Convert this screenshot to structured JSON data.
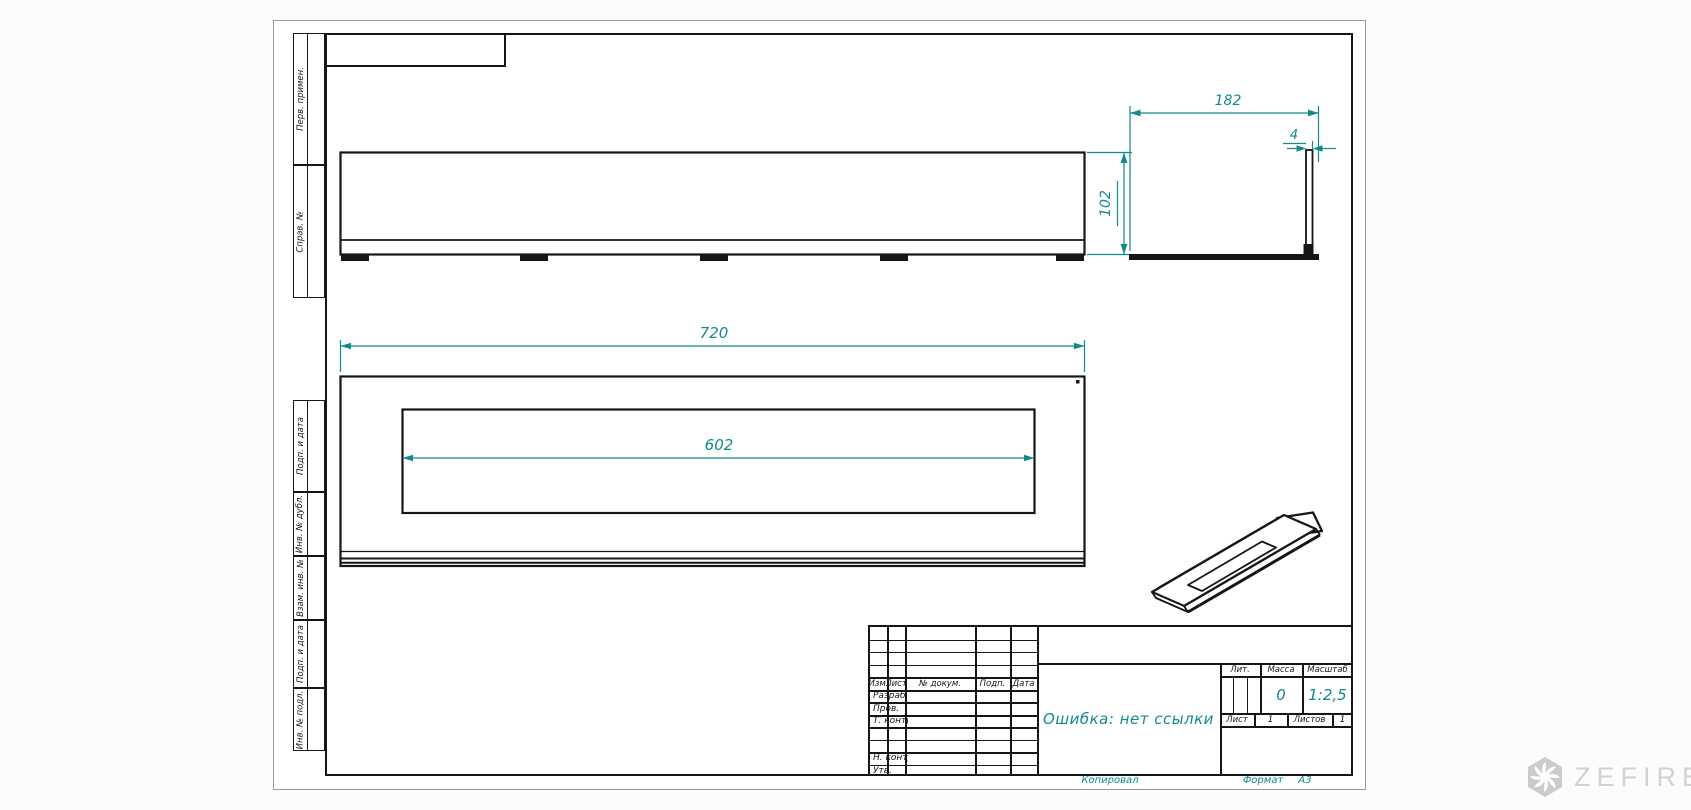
{
  "colors": {
    "accent": "#12898b",
    "line": "#161616",
    "watermark_gray": "#cbcbcb"
  },
  "frame": {
    "strips_top": [
      {
        "label": "Перв. примен."
      },
      {
        "label": "Справ. №"
      }
    ],
    "strips_bottom": [
      {
        "label": "Подп. и дата"
      },
      {
        "label": "Инв. № дубл."
      },
      {
        "label": "Взам. инв. №"
      },
      {
        "label": "Подп. и дата"
      },
      {
        "label": "Инв. № подл."
      }
    ]
  },
  "views": {
    "dims": {
      "overall_width": "720",
      "slot_width": "602",
      "side_width": "182",
      "front_height": "102",
      "flange_thickness": "4"
    }
  },
  "title_block": {
    "header_cols": [
      {
        "label": "Изм."
      },
      {
        "label": "Лист"
      },
      {
        "label": "№ докум."
      },
      {
        "label": "Подп."
      },
      {
        "label": "Дата"
      }
    ],
    "left_rows": [
      {
        "label": "Разраб."
      },
      {
        "label": "Пров."
      },
      {
        "label": "Т. контр."
      },
      {
        "label": ""
      },
      {
        "label": ""
      },
      {
        "label": "Н. контр."
      },
      {
        "label": "Утв."
      }
    ],
    "doc_name": "Ошибка: нет ссылки",
    "lit_label": "Лит.",
    "mass_label": "Масса",
    "scale_label": "Масштаб",
    "mass_value": "0",
    "scale_value": "1:2,5",
    "sheet_label": "Лист",
    "sheet_value": "1",
    "sheets_label": "Листов",
    "sheets_value": "1"
  },
  "footer": {
    "copied": "Копировал",
    "format_label": "Формат",
    "format_value": "А3"
  },
  "watermark": {
    "brand": "ZEFIRE"
  }
}
